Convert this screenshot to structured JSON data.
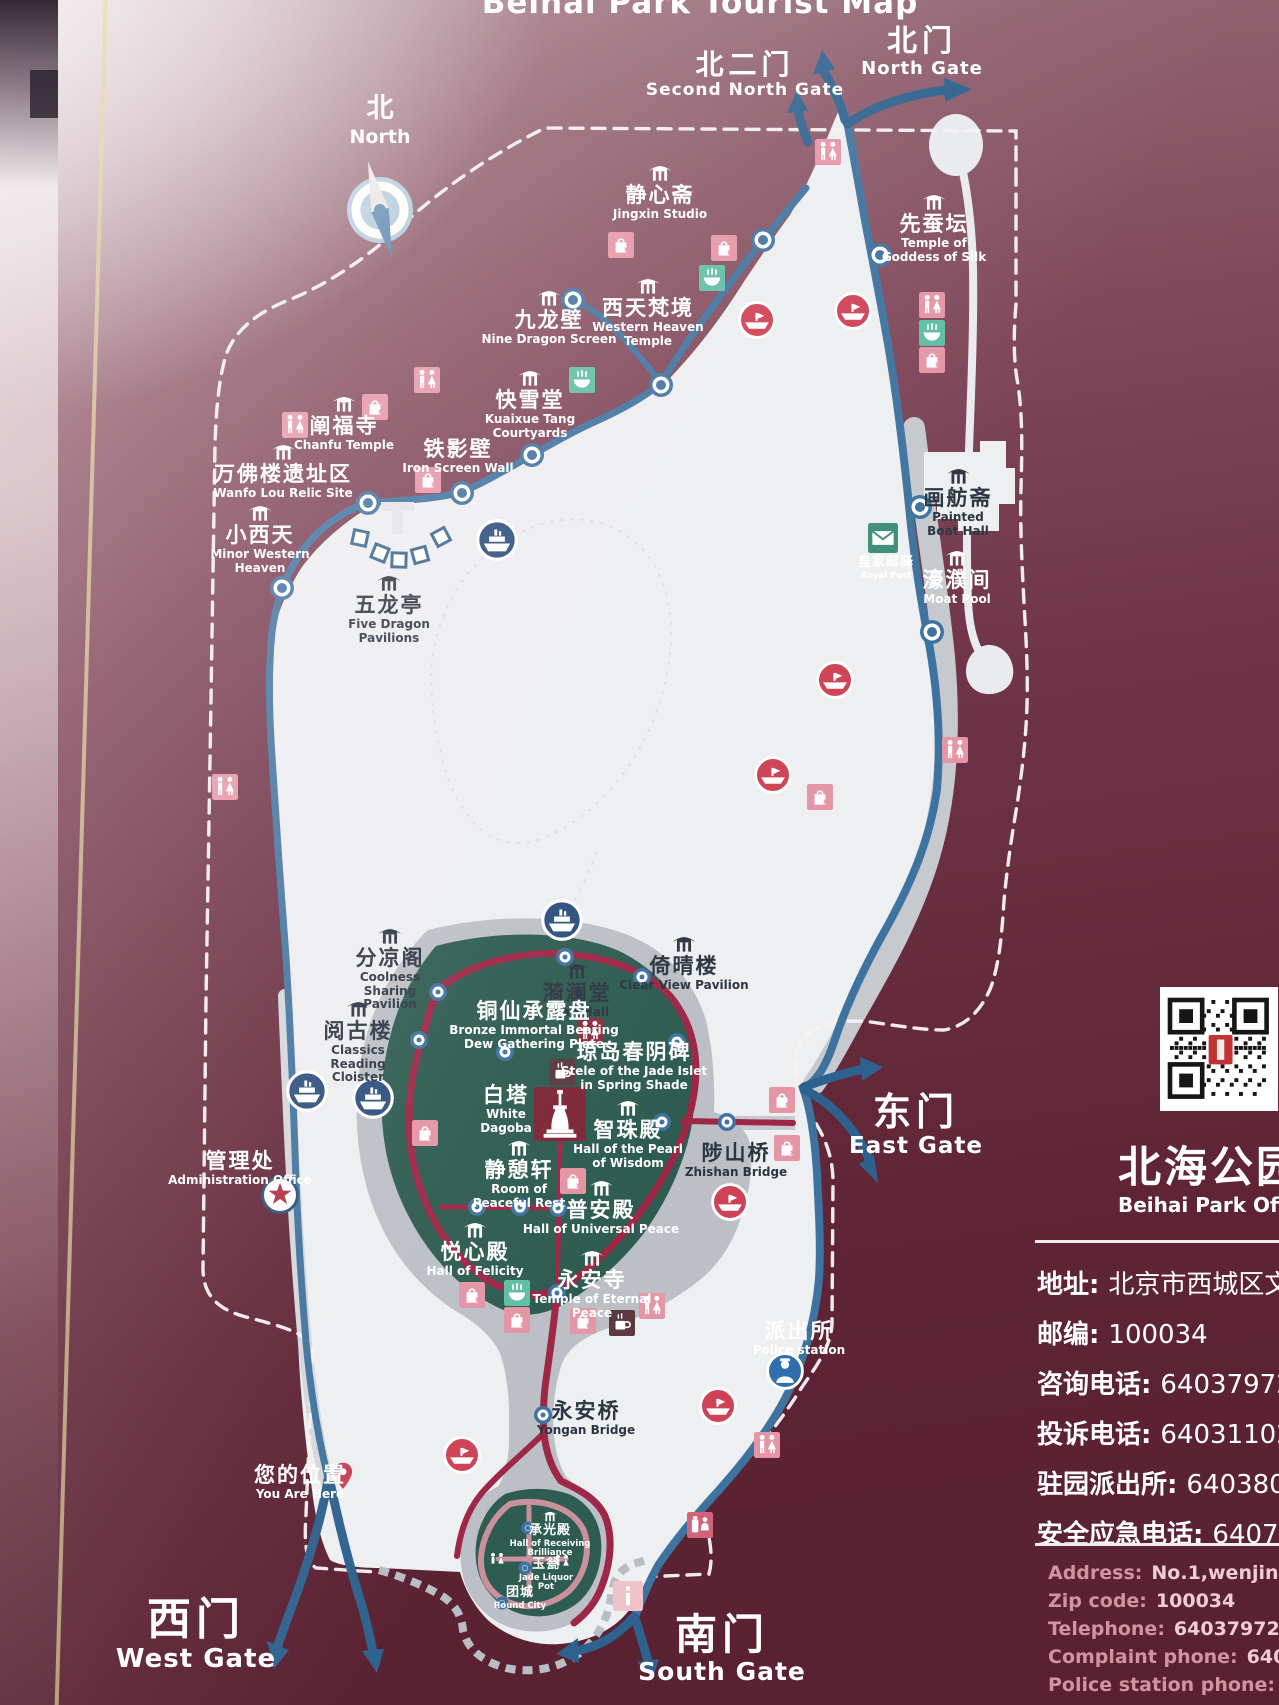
{
  "title": "Beihai Park Tourist Map",
  "compass": {
    "zh": "北",
    "en": "North"
  },
  "gates": [
    {
      "zh": "北门",
      "en": "North Gate",
      "x": 922,
      "y": 26,
      "zhS": 30,
      "enS": 18
    },
    {
      "zh": "北二门",
      "en": "Second North Gate",
      "x": 745,
      "y": 50,
      "zhS": 28,
      "enS": 17
    },
    {
      "zh": "东门",
      "en": "East Gate",
      "x": 916,
      "y": 1092,
      "zhS": 38,
      "enS": 23
    },
    {
      "zh": "西门",
      "en": "West Gate",
      "x": 196,
      "y": 1596,
      "zhS": 44,
      "enS": 26
    },
    {
      "zh": "南门",
      "en": "South Gate",
      "x": 722,
      "y": 1612,
      "zhS": 42,
      "enS": 25
    }
  ],
  "pois": [
    {
      "zh": "静心斋",
      "en": "Jingxin Studio",
      "x": 660,
      "y": 163,
      "icon": 1,
      "tone": "light",
      "enW": 110
    },
    {
      "zh": "先蚕坛",
      "en": "Temple of Goddess of Silk",
      "x": 934,
      "y": 192,
      "icon": 1,
      "tone": "light",
      "enW": 112
    },
    {
      "zh": "九龙壁",
      "en": "Nine Dragon Screen",
      "x": 549,
      "y": 288,
      "icon": 1,
      "tone": "light",
      "enW": 150
    },
    {
      "zh": "西天梵境",
      "en": "Western Heaven Temple",
      "x": 648,
      "y": 276,
      "icon": 1,
      "tone": "light",
      "enW": 118
    },
    {
      "zh": "快雪堂",
      "en": "Kuaixue Tang Courtyards",
      "x": 530,
      "y": 368,
      "icon": 1,
      "tone": "light",
      "enW": 100
    },
    {
      "zh": "阐福寺",
      "en": "Chanfu Temple",
      "x": 344,
      "y": 394,
      "icon": 1,
      "tone": "light",
      "enW": 130
    },
    {
      "zh": "铁影壁",
      "en": "Iron Screen Wall",
      "x": 458,
      "y": 438,
      "icon": 0,
      "tone": "light",
      "enW": 140
    },
    {
      "zh": "万佛楼遗址区",
      "en": "Wanfo Lou Relic Site",
      "x": 283,
      "y": 442,
      "icon": 1,
      "tone": "light",
      "enW": 175
    },
    {
      "zh": "小西天",
      "en": "Minor Western Heaven",
      "x": 260,
      "y": 503,
      "icon": 1,
      "tone": "light",
      "enW": 108
    },
    {
      "zh": "五龙亭",
      "en": "Five Dragon Pavilions",
      "x": 389,
      "y": 573,
      "icon": 1,
      "tone": "dark",
      "enW": 92
    },
    {
      "zh": "画舫斋",
      "en": "Painted Boat Hall",
      "x": 958,
      "y": 466,
      "icon": 1,
      "tone": "dark",
      "enW": 62
    },
    {
      "zh": "濠濮间",
      "en": "Moat Pool",
      "x": 957,
      "y": 548,
      "icon": 1,
      "tone": "light",
      "enW": 90
    },
    {
      "zh": "皇家邮驿",
      "en": "Royal Post",
      "x": 886,
      "y": 556,
      "icon": 0,
      "tone": "light",
      "small": 1,
      "enW": 80
    },
    {
      "zh": "分凉阁",
      "en": "Coolness Sharing Pavilion",
      "x": 390,
      "y": 926,
      "icon": 1,
      "tone": "dark",
      "enW": 100
    },
    {
      "zh": "倚晴楼",
      "en": "Clear View Pavilion",
      "x": 684,
      "y": 934,
      "icon": 1,
      "tone": "dark",
      "enW": 140
    },
    {
      "zh": "漪澜堂",
      "en": "Yilan Hall",
      "x": 577,
      "y": 961,
      "icon": 1,
      "tone": "dark",
      "enW": 90
    },
    {
      "zh": "阅古楼",
      "en": "Classics Reading Cloister",
      "x": 358,
      "y": 999,
      "icon": 1,
      "tone": "dark",
      "enW": 105
    },
    {
      "zh": "铜仙承露盘",
      "en": "Bronze Immortal Bearing Dew Gathering Plate",
      "x": 534,
      "y": 1000,
      "icon": 0,
      "tone": "light",
      "enW": 175
    },
    {
      "zh": "琼岛春阴碑",
      "en": "Stele of the Jade Islet in Spring Shade",
      "x": 634,
      "y": 1041,
      "icon": 0,
      "tone": "light",
      "enW": 152
    },
    {
      "zh": "白塔",
      "en": "White Dagoba",
      "x": 506,
      "y": 1084,
      "icon": 0,
      "tone": "light",
      "enW": 55
    },
    {
      "zh": "智珠殿",
      "en": "Hall of the Pearl of Wisdom",
      "x": 628,
      "y": 1098,
      "icon": 1,
      "tone": "light",
      "enW": 112
    },
    {
      "zh": "静憩轩",
      "en": "Room of Peaceful Rest",
      "x": 519,
      "y": 1138,
      "icon": 1,
      "tone": "light",
      "enW": 98
    },
    {
      "zh": "普安殿",
      "en": "Hall of Universal Peace",
      "x": 601,
      "y": 1178,
      "icon": 1,
      "tone": "light",
      "enW": 165
    },
    {
      "zh": "陟山桥",
      "en": "Zhishan Bridge",
      "x": 736,
      "y": 1142,
      "icon": 0,
      "tone": "dark",
      "enW": 110
    },
    {
      "zh": "悦心殿",
      "en": "Hall of Felicity",
      "x": 475,
      "y": 1220,
      "icon": 1,
      "tone": "light",
      "enW": 110
    },
    {
      "zh": "永安寺",
      "en": "Temple of Eternal Peace",
      "x": 592,
      "y": 1248,
      "icon": 1,
      "tone": "light",
      "enW": 122
    },
    {
      "zh": "管理处",
      "en": "Administration Office",
      "x": 240,
      "y": 1150,
      "icon": 0,
      "tone": "light",
      "enW": 175
    },
    {
      "zh": "派出所",
      "en": "Police station",
      "x": 799,
      "y": 1320,
      "icon": 0,
      "tone": "light",
      "enW": 110
    },
    {
      "zh": "您的位置",
      "en": "You Are Here",
      "x": 300,
      "y": 1464,
      "icon": 0,
      "tone": "light",
      "enW": 110
    },
    {
      "zh": "永安桥",
      "en": "Yongan Bridge",
      "x": 586,
      "y": 1400,
      "icon": 0,
      "tone": "dark",
      "enW": 110
    },
    {
      "zh": "承光殿",
      "en": "Hall of Receiving Brilliance",
      "x": 550,
      "y": 1510,
      "icon": 1,
      "tone": "light",
      "small": 1,
      "enW": 125
    },
    {
      "zh": "玉瓮",
      "en": "Jade Liquor Pot",
      "x": 546,
      "y": 1558,
      "icon": 0,
      "tone": "light",
      "small": 1,
      "enW": 58
    },
    {
      "zh": "团城",
      "en": "Round City",
      "x": 520,
      "y": 1586,
      "icon": 0,
      "tone": "light",
      "small": 1,
      "enW": 70
    }
  ],
  "amenities": [
    {
      "type": "wc",
      "x": 828,
      "y": 152
    },
    {
      "type": "shop",
      "x": 621,
      "y": 245
    },
    {
      "type": "shop",
      "x": 724,
      "y": 248
    },
    {
      "type": "rest",
      "x": 712,
      "y": 278
    },
    {
      "type": "boat",
      "x": 757,
      "y": 320
    },
    {
      "type": "boat",
      "x": 853,
      "y": 311
    },
    {
      "type": "wc",
      "x": 932,
      "y": 305
    },
    {
      "type": "rest",
      "x": 932,
      "y": 333
    },
    {
      "type": "shop",
      "x": 932,
      "y": 360
    },
    {
      "type": "wc",
      "x": 427,
      "y": 380
    },
    {
      "type": "rest",
      "x": 582,
      "y": 380
    },
    {
      "type": "wc",
      "x": 295,
      "y": 425
    },
    {
      "type": "shop",
      "x": 375,
      "y": 407
    },
    {
      "type": "shop",
      "x": 428,
      "y": 480
    },
    {
      "type": "ship",
      "x": 497,
      "y": 540
    },
    {
      "type": "post",
      "x": 883,
      "y": 538
    },
    {
      "type": "boat",
      "x": 835,
      "y": 680
    },
    {
      "type": "wc",
      "x": 955,
      "y": 750
    },
    {
      "type": "boat",
      "x": 773,
      "y": 775
    },
    {
      "type": "shop",
      "x": 820,
      "y": 797
    },
    {
      "type": "wc",
      "x": 225,
      "y": 787
    },
    {
      "type": "ship",
      "x": 562,
      "y": 920
    },
    {
      "type": "ship",
      "x": 307,
      "y": 1091
    },
    {
      "type": "ship",
      "x": 373,
      "y": 1098
    },
    {
      "type": "wcdark",
      "x": 590,
      "y": 1031
    },
    {
      "type": "coffee",
      "x": 562,
      "y": 1072
    },
    {
      "type": "shop",
      "x": 425,
      "y": 1133
    },
    {
      "type": "shop",
      "x": 573,
      "y": 1181
    },
    {
      "type": "shop",
      "x": 782,
      "y": 1100
    },
    {
      "type": "shop",
      "x": 787,
      "y": 1148
    },
    {
      "type": "boat",
      "x": 730,
      "y": 1202
    },
    {
      "type": "shop",
      "x": 472,
      "y": 1295
    },
    {
      "type": "rest",
      "x": 517,
      "y": 1293
    },
    {
      "type": "wc",
      "x": 652,
      "y": 1306
    },
    {
      "type": "shop",
      "x": 517,
      "y": 1320
    },
    {
      "type": "shop",
      "x": 583,
      "y": 1321
    },
    {
      "type": "coffee",
      "x": 622,
      "y": 1323
    },
    {
      "type": "police",
      "x": 785,
      "y": 1371
    },
    {
      "type": "star",
      "x": 280,
      "y": 1195
    },
    {
      "type": "pin",
      "x": 343,
      "y": 1476
    },
    {
      "type": "boat",
      "x": 718,
      "y": 1406
    },
    {
      "type": "boat",
      "x": 462,
      "y": 1455
    },
    {
      "type": "wc",
      "x": 767,
      "y": 1445
    },
    {
      "type": "service",
      "x": 700,
      "y": 1525
    },
    {
      "type": "info",
      "x": 628,
      "y": 1596
    },
    {
      "type": "wcplain",
      "x": 497,
      "y": 1560
    },
    {
      "type": "wcplain",
      "x": 562,
      "y": 1562
    },
    {
      "type": "dagoba",
      "x": 560,
      "y": 1114
    }
  ],
  "panel": {
    "park_name_zh": "北海公园官",
    "park_name_en": "Beihai Park Offical",
    "contact_zh": [
      {
        "label": "地址:",
        "value": "北京市西城区文"
      },
      {
        "label": "邮编:",
        "value": "100034"
      },
      {
        "label": "咨询电话:",
        "value": "64037972"
      },
      {
        "label": "投诉电话:",
        "value": "64031102"
      },
      {
        "label": "驻园派出所:",
        "value": "640380"
      },
      {
        "label": "安全应急电话:",
        "value": "6407"
      }
    ],
    "contact_en": [
      {
        "label": "Address:",
        "value": "No.1,wenjin street,x"
      },
      {
        "label": "Zip code:",
        "value": "100034"
      },
      {
        "label": "Telephone:",
        "value": "64037972 / 6403"
      },
      {
        "label": "Complaint phone:",
        "value": "6403110"
      },
      {
        "label": "Police station phone:",
        "value": "64038"
      },
      {
        "label": "Emergency phone:",
        "value": "6407141"
      }
    ]
  },
  "colors": {
    "background_maroon": "#662b3d",
    "lake": "#edeff1",
    "island_green": "#2e5c50",
    "road_blue": "#3f739f",
    "road_red": "#9e2746",
    "shore_gray": "#c3c7cc",
    "amenity_pink": "#e495a6",
    "amenity_green": "#5fbfa3",
    "boat_red": "#cf4256",
    "ship_navy": "#2c4f7c"
  }
}
